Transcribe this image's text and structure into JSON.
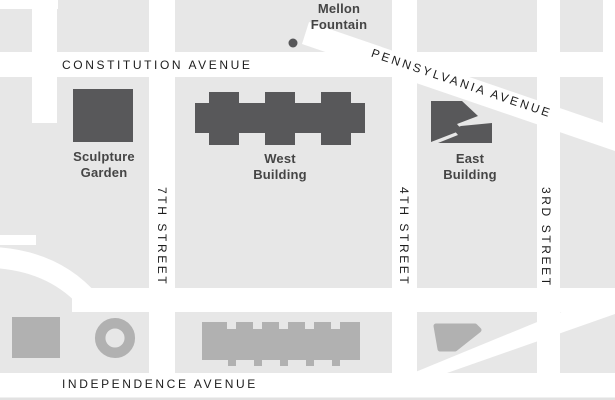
{
  "map": {
    "streets": {
      "constitution": "CONSTITUTION AVENUE",
      "pennsylvania": "PENNSYLVANIA AVENUE",
      "independence": "INDEPENDENCE AVENUE",
      "seventh": "7TH STREET",
      "fourth": "4TH STREET",
      "third": "3RD STREET"
    },
    "places": {
      "mellon": {
        "line1": "Mellon",
        "line2": "Fountain"
      },
      "sculpture": {
        "line1": "Sculpture",
        "line2": "Garden"
      },
      "west": {
        "line1": "West",
        "line2": "Building"
      },
      "east": {
        "line1": "East",
        "line2": "Building"
      }
    },
    "colors": {
      "block_gray": "#e7e7e7",
      "street_white": "#ffffff",
      "building_dark": "#58585a",
      "building_light": "#b1b1b1",
      "place_label": "#454545",
      "street_label": "#1c1c1c",
      "bottom_edge": "#e2e2e2"
    }
  }
}
